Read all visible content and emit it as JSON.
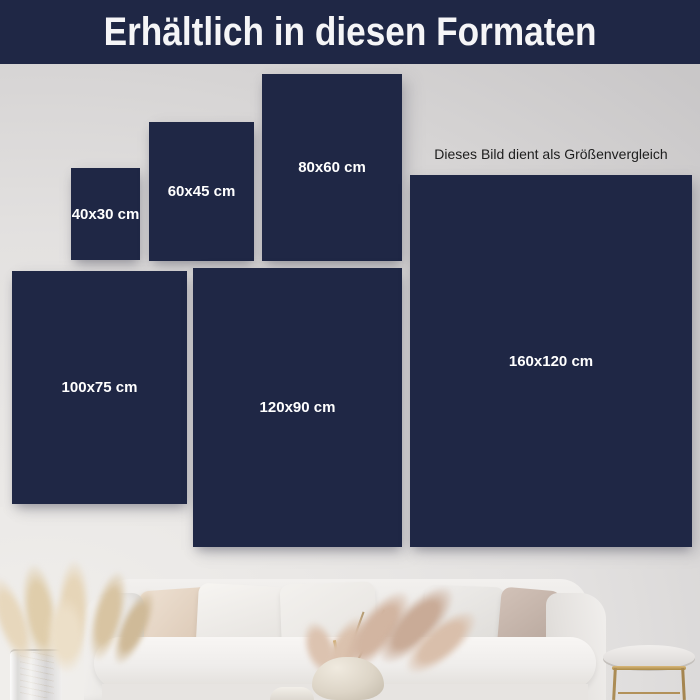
{
  "header": {
    "title": "Erhältlich in diesen Formaten"
  },
  "note": {
    "text": "Dieses Bild dient als Größenvergleich"
  },
  "sizes": [
    {
      "label": "40x30 cm"
    },
    {
      "label": "60x45 cm"
    },
    {
      "label": "80x60 cm"
    },
    {
      "label": "100x75 cm"
    },
    {
      "label": "120x90 cm"
    },
    {
      "label": "160x120 cm"
    }
  ],
  "colors": {
    "navy": "#1f2745",
    "label_text": "#ffffff",
    "note_text": "#1d1d1d",
    "wall_light": "#f1efec",
    "wall_mid": "#e3e1e0",
    "wall_dark": "#c9c7c8"
  }
}
